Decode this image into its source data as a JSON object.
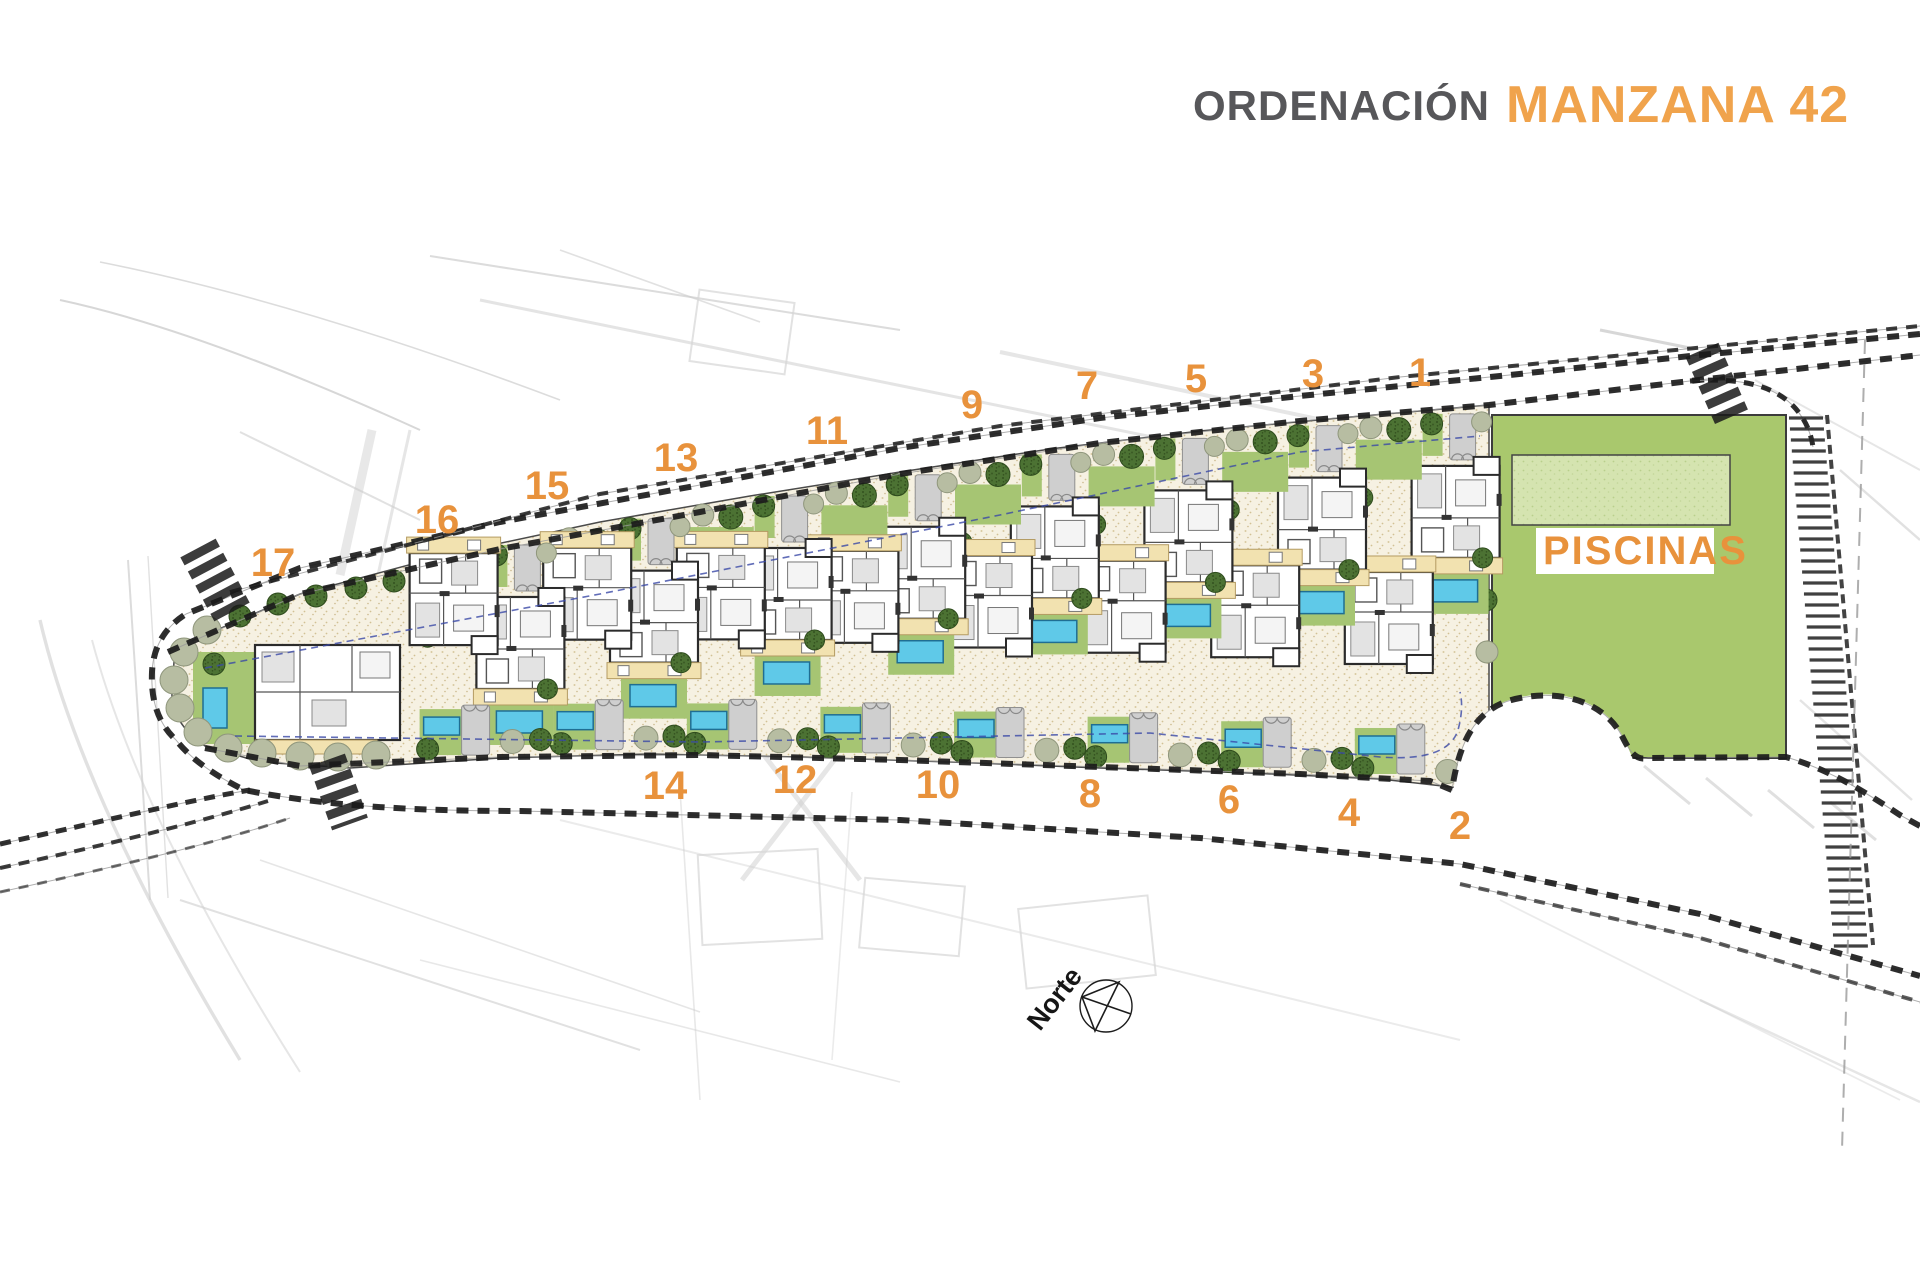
{
  "title": {
    "ordenacion": "ORDENACIÓN",
    "manzana": "MANZANA 42"
  },
  "labels": {
    "piscinas": "PISCINAS",
    "north": "Norte"
  },
  "plots": {
    "top_row": [
      {
        "n": "1",
        "x": 1420,
        "y": 372
      },
      {
        "n": "3",
        "x": 1313,
        "y": 373
      },
      {
        "n": "5",
        "x": 1196,
        "y": 378
      },
      {
        "n": "7",
        "x": 1087,
        "y": 385
      },
      {
        "n": "9",
        "x": 972,
        "y": 404
      },
      {
        "n": "11",
        "x": 827,
        "y": 430
      },
      {
        "n": "13",
        "x": 676,
        "y": 457
      },
      {
        "n": "15",
        "x": 547,
        "y": 485
      },
      {
        "n": "16",
        "x": 437,
        "y": 519
      },
      {
        "n": "17",
        "x": 273,
        "y": 562
      }
    ],
    "bottom_row": [
      {
        "n": "14",
        "x": 665,
        "y": 785
      },
      {
        "n": "12",
        "x": 795,
        "y": 779
      },
      {
        "n": "10",
        "x": 938,
        "y": 784
      },
      {
        "n": "8",
        "x": 1090,
        "y": 793
      },
      {
        "n": "6",
        "x": 1229,
        "y": 799
      },
      {
        "n": "4",
        "x": 1349,
        "y": 812
      },
      {
        "n": "2",
        "x": 1460,
        "y": 825
      }
    ]
  },
  "colors": {
    "accent_orange": "#e8923c",
    "title_gray": "#57575a",
    "lawn": "#a6c573",
    "piscinas_green": "#a9c86d",
    "piscinas_inner": "#d5e4b0",
    "pool_blue": "#5fc9e8",
    "pool_edge": "#1f6e93",
    "ground": "#f6f1e2",
    "ground_dot": "#d8c9a0",
    "tree_dark": "#4c7233",
    "tree_dark_dot": "#33511f",
    "tree_sage": "#b7bda2",
    "road_hatch": "#1b1b1b",
    "terrace": "#f2e2b0",
    "driveway": "#cfcfcf",
    "wall": "#2b2b2b",
    "blue_dash": "#3a49a6",
    "sketch": "#cdcdcd"
  }
}
